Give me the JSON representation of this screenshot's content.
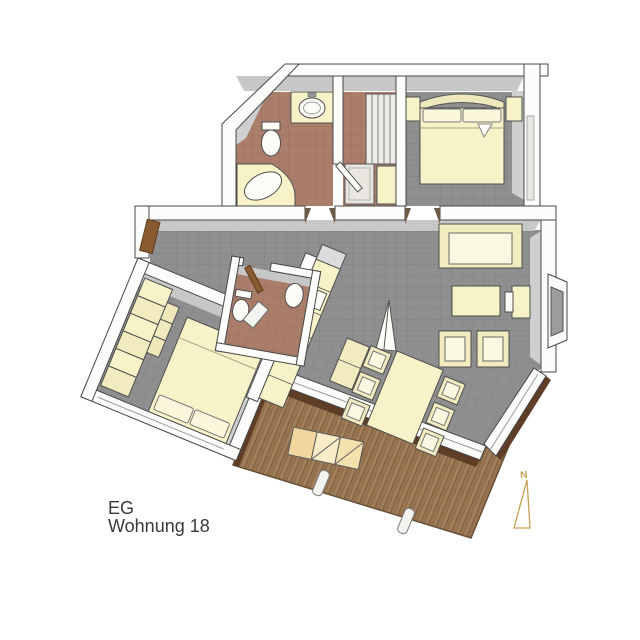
{
  "labels": {
    "line1": "EG",
    "line2": "Wohnung 18"
  },
  "north_arrow": {
    "letter": "N"
  },
  "palette": {
    "background": "#d8d8d7",
    "background_light": "#f7f7f3",
    "wall_fill": "#fcfcfb",
    "wall_outline": "#474747",
    "wall_inner_shadow": "#c7c7c7",
    "tile_gray": "#8f8f8f",
    "tile_gray_grout": "#828282",
    "tile_terracotta": "#ab7e6c",
    "tile_terracotta_grout": "#9c7160",
    "furniture_cream": "#f7f2c8",
    "fixture_white": "#fdfdf8",
    "deck_wood": "#a07c58",
    "deck_wood_dark": "#6f5338",
    "deck_edge_brown": "#5e3e27",
    "door_brown": "#8a5a31",
    "north_arrow_gold": "#c6a055",
    "label_text": "#3a3a3a"
  }
}
